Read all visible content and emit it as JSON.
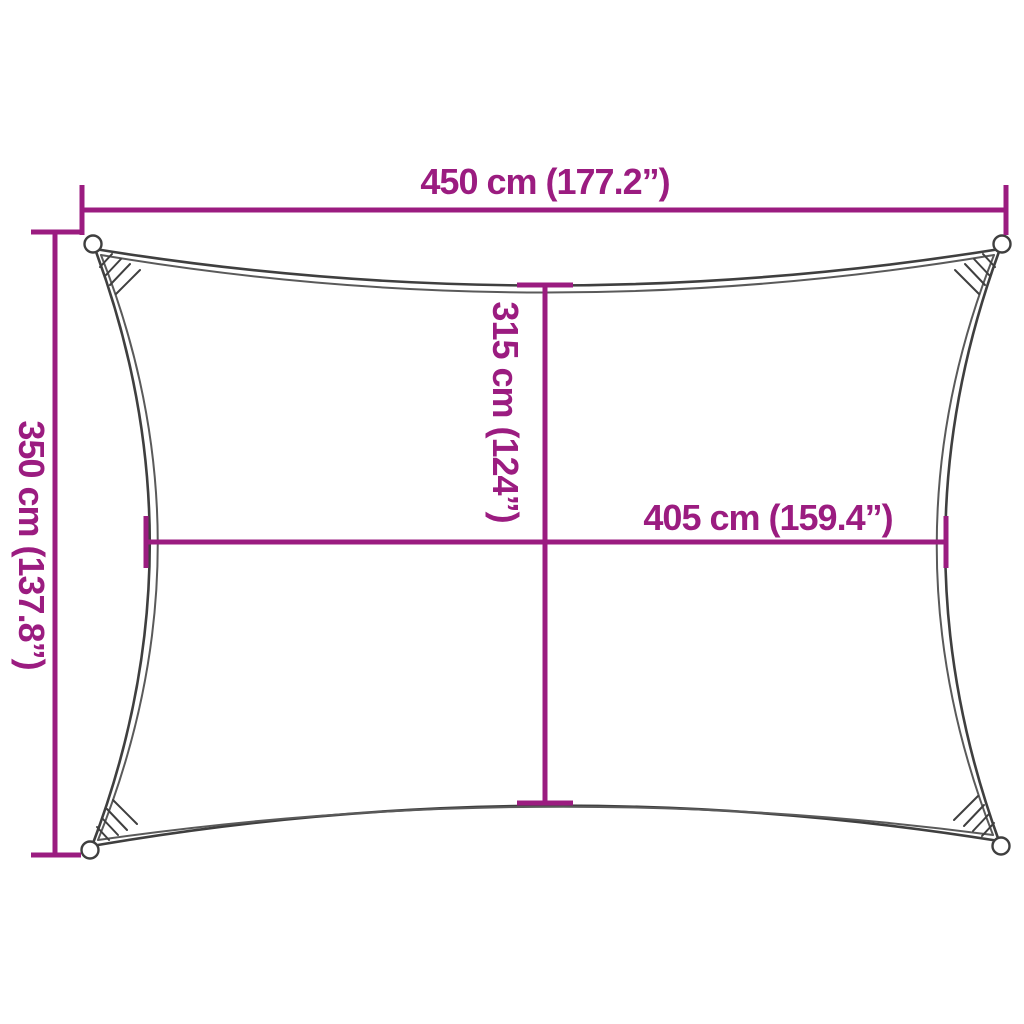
{
  "diagram": {
    "subject": "rectangular shade sail dimension drawing",
    "colors": {
      "dimension_accent": "#9B1C80",
      "sail_outline": "#3F3F3F",
      "background": "#FFFFFF"
    },
    "dimensions": {
      "width": {
        "label": "450 cm (177.2”)",
        "cm": 450,
        "inches": 177.2
      },
      "height": {
        "label": "350 cm (137.8”)",
        "cm": 350,
        "inches": 137.8
      },
      "inner_height": {
        "label": "315 cm (124”)",
        "cm": 315,
        "inches": 124
      },
      "inner_width": {
        "label": "405 cm (159.4”)",
        "cm": 405,
        "inches": 159.4
      }
    }
  }
}
